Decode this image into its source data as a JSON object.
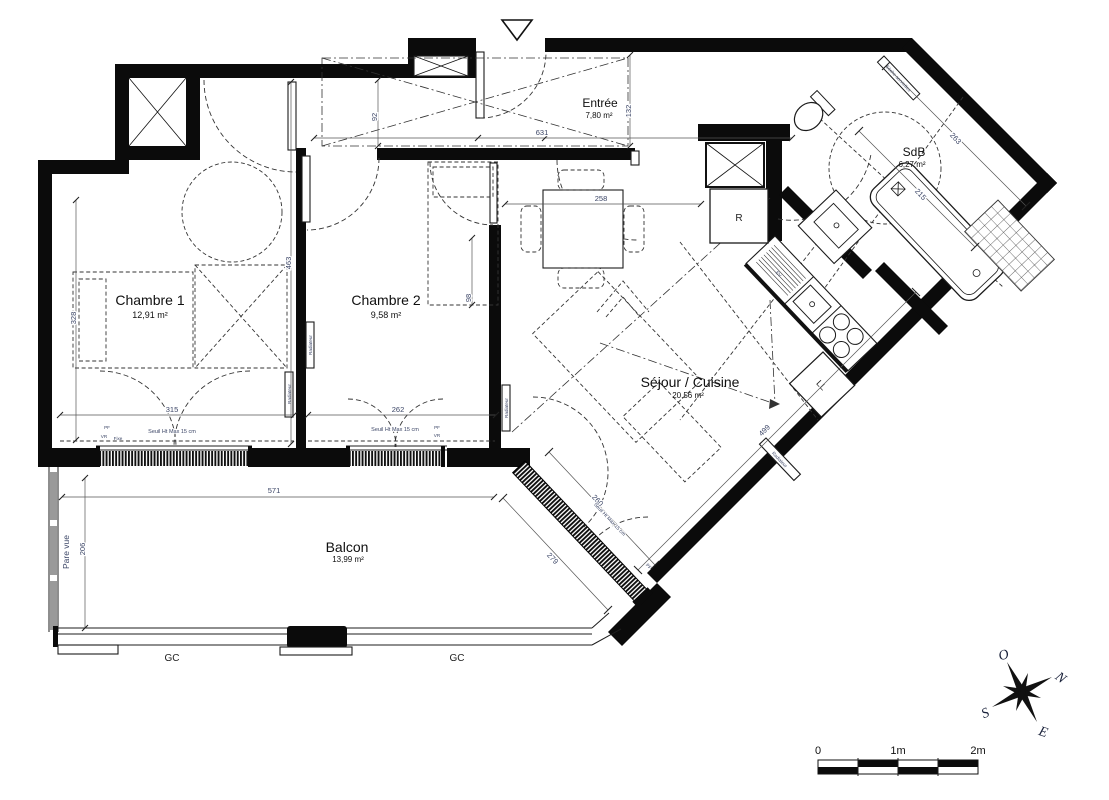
{
  "rooms": {
    "chambre1": {
      "name": "Chambre 1",
      "area": "12,91 m²"
    },
    "chambre2": {
      "name": "Chambre 2",
      "area": "9,58 m²"
    },
    "entree": {
      "name": "Entrée",
      "area": "7,80 m²"
    },
    "sdb": {
      "name": "SdB",
      "area": "6,27 m²"
    },
    "sejour": {
      "name": "Séjour / Cuisine",
      "area": "20,56 m²"
    },
    "balcon": {
      "name": "Balcon",
      "area": "13,99 m²"
    }
  },
  "dimensions_cm": {
    "entree_width": "631",
    "entree_height": "132",
    "hall_door": "92",
    "dining_width": "258",
    "ch1_wall": "463",
    "ch1_height": "328",
    "ch1_width": "315",
    "ch2_width": "262",
    "ch2_bed": "98",
    "balcon_width": "571",
    "balcon_depth": "206",
    "sejour_diagonal": "499",
    "bay_inner": "260",
    "bay_outer": "279",
    "sdb_long": "263",
    "sdb_short": "215"
  },
  "annotations": {
    "radiator": "Radiateur",
    "privacy_screen": "Pare vue",
    "gc": "GC",
    "threshold": "Seuil Ht Max 15 cm",
    "pf": "PF",
    "vr": "VR",
    "fixed": "Fixe",
    "fridge": "R",
    "washer": "LL",
    "sink_unit": "EV",
    "towel_dryer": "Sèche-serviettes"
  },
  "compass": {
    "north": "N",
    "south": "S",
    "east": "E",
    "west": "O"
  },
  "scale_bar": {
    "zero": "0",
    "one": "1m",
    "two": "2m"
  }
}
